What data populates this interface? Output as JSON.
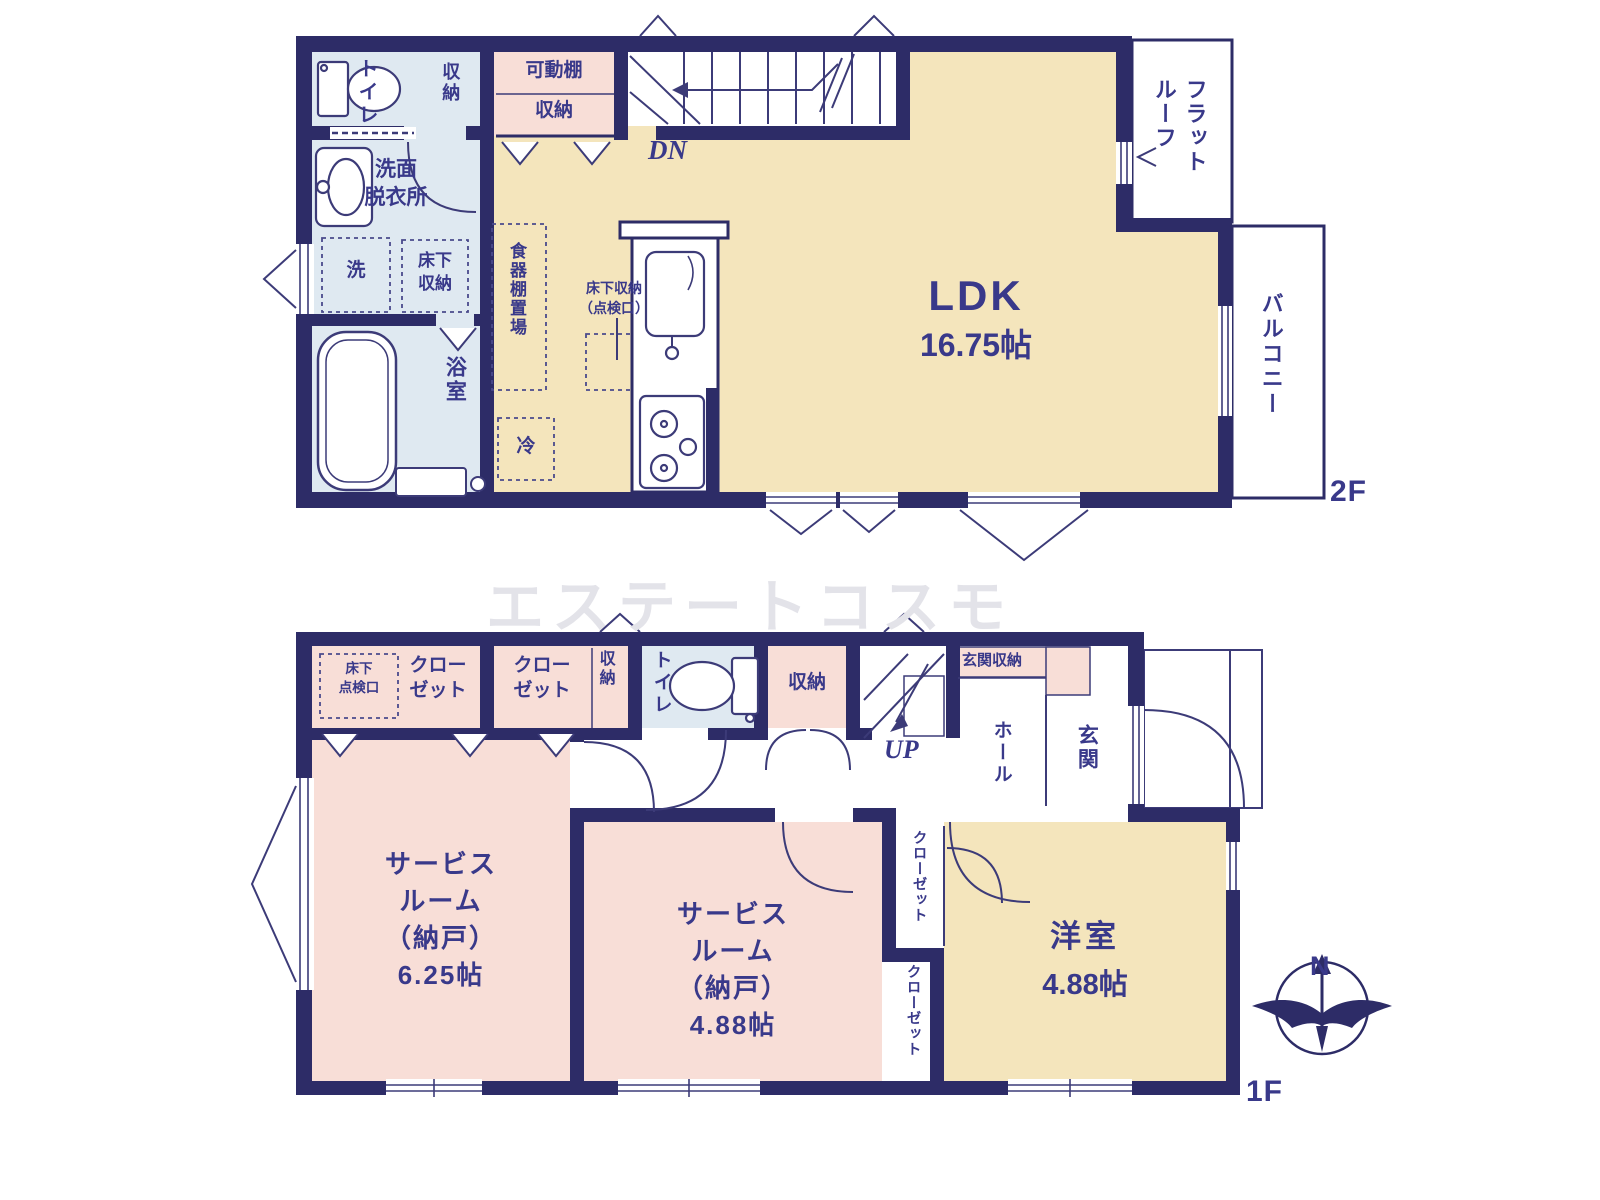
{
  "watermark": "エステートコスモ",
  "colors": {
    "wall": "#2d2c67",
    "room_cream": "#f4e5bc",
    "room_pink": "#f8ded7",
    "room_blue": "#dfe9f1",
    "text": "#39398a",
    "watermark": "#e3e3e9"
  },
  "floor2": {
    "tag": "2F",
    "toilet": "トイレ",
    "toilet_storage": "収納",
    "movable_shelf": "可動棚",
    "shelf_storage": "収納",
    "stairs_dn": "DN",
    "washroom": "洗面\n脱衣所",
    "washer": "洗",
    "underfloor_storage": "床下\n収納",
    "bathroom": "浴室",
    "dish_shelf_area": "食器棚置場",
    "underfloor_inspection": "床下収納\n（点検口）",
    "fridge": "冷",
    "ldk": "LDK",
    "ldk_size": "16.75帖",
    "flat_roof": "フラットルーフ",
    "balcony": "バルコニー"
  },
  "floor1": {
    "tag": "1F",
    "underfloor_inspection": "床下\n点検口",
    "closet_a": "クロー\nゼット",
    "closet_b": "クロー\nゼット",
    "storage_small": "収納",
    "toilet": "トイレ",
    "storage": "収納",
    "stairs_up": "UP",
    "entrance_storage": "玄関収納",
    "hall": "ホール",
    "entrance": "玄関",
    "service_room_1": "サービス\nルーム\n（納戸）\n6.25帖",
    "service_room_2": "サービス\nルーム\n（納戸）\n4.88帖",
    "closet_v1": "クローゼット",
    "closet_v2": "クローゼット",
    "western_room": "洋室",
    "western_room_size": "4.88帖",
    "compass_north": "N"
  }
}
